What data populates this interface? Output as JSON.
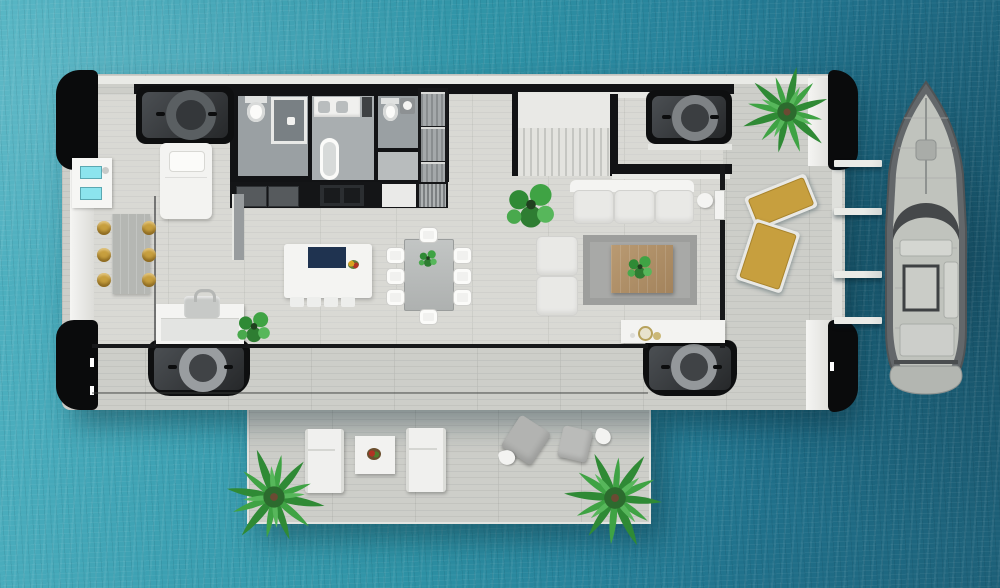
{
  "scene": {
    "type": "floorplan-render",
    "view": "top-down",
    "no_visible_text": true,
    "description": "Top-down 3D floor plan of a floating house on teal sea water: interior with three bathrooms, kitchen, stairs, living and dining areas; outdoor decks with palm trees and loungers; four corner mooring units with circular hatches; a finger pier with four planks and a motor yacht moored on the right."
  },
  "colors": {
    "water_light": "#51b3c2",
    "water_deep": "#1d6078",
    "deck_plank": "#cdcec9",
    "interior_floor": "#d9d9d4",
    "wall_black": "#121315",
    "wall_white": "#eceded",
    "accent_gold": "#c79f3e",
    "cooktop_navy": "#1f3350",
    "screen_cyan": "#8ce4ee",
    "plant_green": "#3c9a3f",
    "rug_gray": "#a8a9a7",
    "boat_hull": "#63676a",
    "boat_deck": "#c0c3bd",
    "tech_unit_black": "#0e0f10"
  },
  "labels": {
    "water": "sea water",
    "main_deck": "main floating platform",
    "lower_deck": "lower sun deck",
    "interior_floor": "interior wood floor",
    "top_wall": "north exterior wall",
    "left_wall": "west exterior wall",
    "right_wall": "east exterior wall panel",
    "pontoon": "black flotation pontoon",
    "control_panel": "utility control panel with cyan screens",
    "bathroom_left": "bathroom with shower",
    "bathroom_middle": "bathroom with bathtub",
    "bathroom_right": "guest toilet room",
    "toilet": "toilet",
    "shower": "walk-in shower",
    "bathtub": "bathtub",
    "vanity": "washbasin vanity",
    "closet": "closet / laundry column",
    "kitchen_counter": "kitchen counter with appliances",
    "kitchen_island": "kitchen island with navy cooktop",
    "island_stool": "island stool",
    "bar_table": "bar table",
    "bar_stool": "gold bar stool",
    "daybed": "daybed",
    "stairs": "staircase",
    "landing": "stair landing",
    "tech_unit": "corner mooring unit with round hatch",
    "sofa": "three-seat sofa",
    "chaise": "two-seat chaise sofa",
    "rug": "area rug",
    "coffee_table": "wooden coffee table",
    "sideboard": "sideboard with bowls",
    "side_table": "side table",
    "door": "glass wall door",
    "glass_wall": "glass wall",
    "partition": "glass partition",
    "seam": "deck seam",
    "desk": "cabinet with sink",
    "desk_item": "portable cooler",
    "desk_plant": "potted plant",
    "monstera": "monstera plant",
    "gold_lounger": "gold sun lounger",
    "white_lounger": "white sun lounger",
    "deck_table": "outdoor table",
    "plate": "food plate",
    "pouf": "grey pouf",
    "tri_table": "small side table",
    "palm": "palm tree",
    "pier_plank": "pier plank",
    "boat": "motor yacht",
    "dining_table": "dining table",
    "dining_chair": "dining chair",
    "centerpiece": "table centerpiece plant",
    "fruit_bowl": "fruit bowl"
  },
  "inventory": {
    "bathrooms": 3,
    "corner_tech_units": 4,
    "palm_trees": 3,
    "dining_chairs": 8,
    "bar_stools": 6,
    "island_stools": 4,
    "gold_loungers": 2,
    "white_loungers": 2,
    "poufs": 2,
    "pier_planks": 4,
    "sofa_seats": 3,
    "boats": 1
  }
}
